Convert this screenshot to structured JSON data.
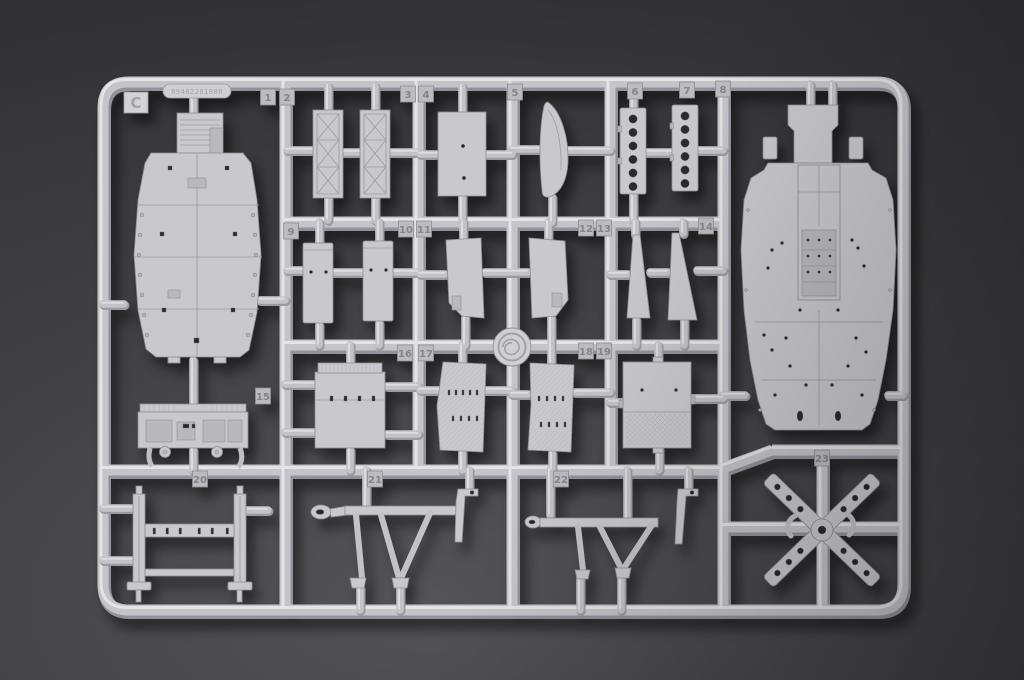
{
  "scene": {
    "type": "photograph",
    "subject": "light-gray injection-molded plastic model kit sprue (parts runner) lying on a dark gray background",
    "sprue_letter": "C",
    "mold_code": "09482201000",
    "part_count": 23
  },
  "sprue": {
    "letter": "C",
    "mold_code": "09482201000",
    "part_tabs": [
      {
        "label": "1",
        "x": 268,
        "y": 97
      },
      {
        "label": "2",
        "x": 287,
        "y": 97
      },
      {
        "label": "3",
        "x": 408,
        "y": 94
      },
      {
        "label": "4",
        "x": 426,
        "y": 94
      },
      {
        "label": "5",
        "x": 515,
        "y": 92
      },
      {
        "label": "6",
        "x": 635,
        "y": 91
      },
      {
        "label": "7",
        "x": 687,
        "y": 90
      },
      {
        "label": "8",
        "x": 723,
        "y": 89
      },
      {
        "label": "9",
        "x": 291,
        "y": 231
      },
      {
        "label": "10",
        "x": 406,
        "y": 229
      },
      {
        "label": "11",
        "x": 424,
        "y": 229
      },
      {
        "label": "12",
        "x": 586,
        "y": 228
      },
      {
        "label": "13",
        "x": 604,
        "y": 228
      },
      {
        "label": "14",
        "x": 706,
        "y": 226
      },
      {
        "label": "15",
        "x": 263,
        "y": 396
      },
      {
        "label": "16",
        "x": 405,
        "y": 353
      },
      {
        "label": "17",
        "x": 426,
        "y": 353
      },
      {
        "label": "18",
        "x": 586,
        "y": 351
      },
      {
        "label": "19",
        "x": 604,
        "y": 351
      },
      {
        "label": "20",
        "x": 200,
        "y": 479
      },
      {
        "label": "21",
        "x": 375,
        "y": 479
      },
      {
        "label": "22",
        "x": 561,
        "y": 479
      },
      {
        "label": "23",
        "x": 822,
        "y": 458
      }
    ]
  },
  "colors": {
    "background": "#3e3e41",
    "plastic": "#c9c9cd",
    "plastic_highlight": "#ebebed",
    "plastic_shadow": "#8e8e92",
    "hole": "#2c2c2e"
  }
}
